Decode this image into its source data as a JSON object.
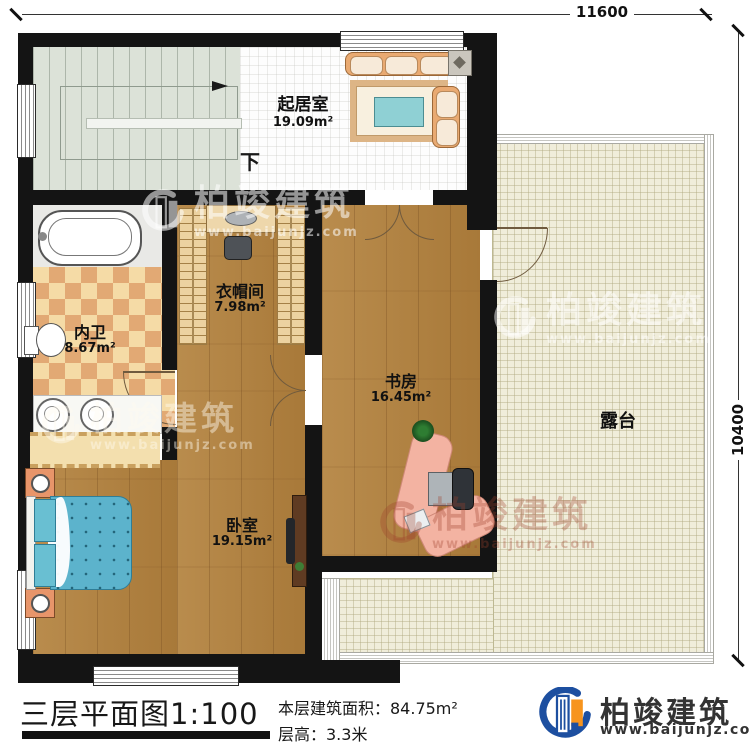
{
  "dimensions": {
    "top": "11600",
    "right": "10400"
  },
  "rooms": [
    {
      "name": "起居室",
      "area": "19.09m²"
    },
    {
      "name": "衣帽间",
      "area": "7.98m²"
    },
    {
      "name": "内卫",
      "area": "8.67m²"
    },
    {
      "name": "书房",
      "area": "16.45m²"
    },
    {
      "name": "卧室",
      "area": "19.15m²"
    },
    {
      "name": "露台",
      "area": ""
    }
  ],
  "stairs": {
    "down_label": "下"
  },
  "title_block": {
    "title": "三层平面图",
    "scale": "1:100",
    "floor_area": "本层建筑面积：84.75m²",
    "floor_height": "层高：3.3米"
  },
  "brand": {
    "name": "柏竣建筑",
    "url": "www.baijunjz.com"
  },
  "watermark": {
    "name": "柏竣建筑",
    "url": "www.baijunjz.com"
  },
  "colors": {
    "wood": "#b28344",
    "terrace": "#f0edda",
    "checker_light": "#f5dba6",
    "checker_dark": "#e2a974",
    "stair": "#dce2d8",
    "bed_blue": "#5cb3cc",
    "sofa_tan": "#e9aa72",
    "brand_blue": "#1d4fa0",
    "brand_orange": "#f7941d",
    "wall": "#141414"
  }
}
